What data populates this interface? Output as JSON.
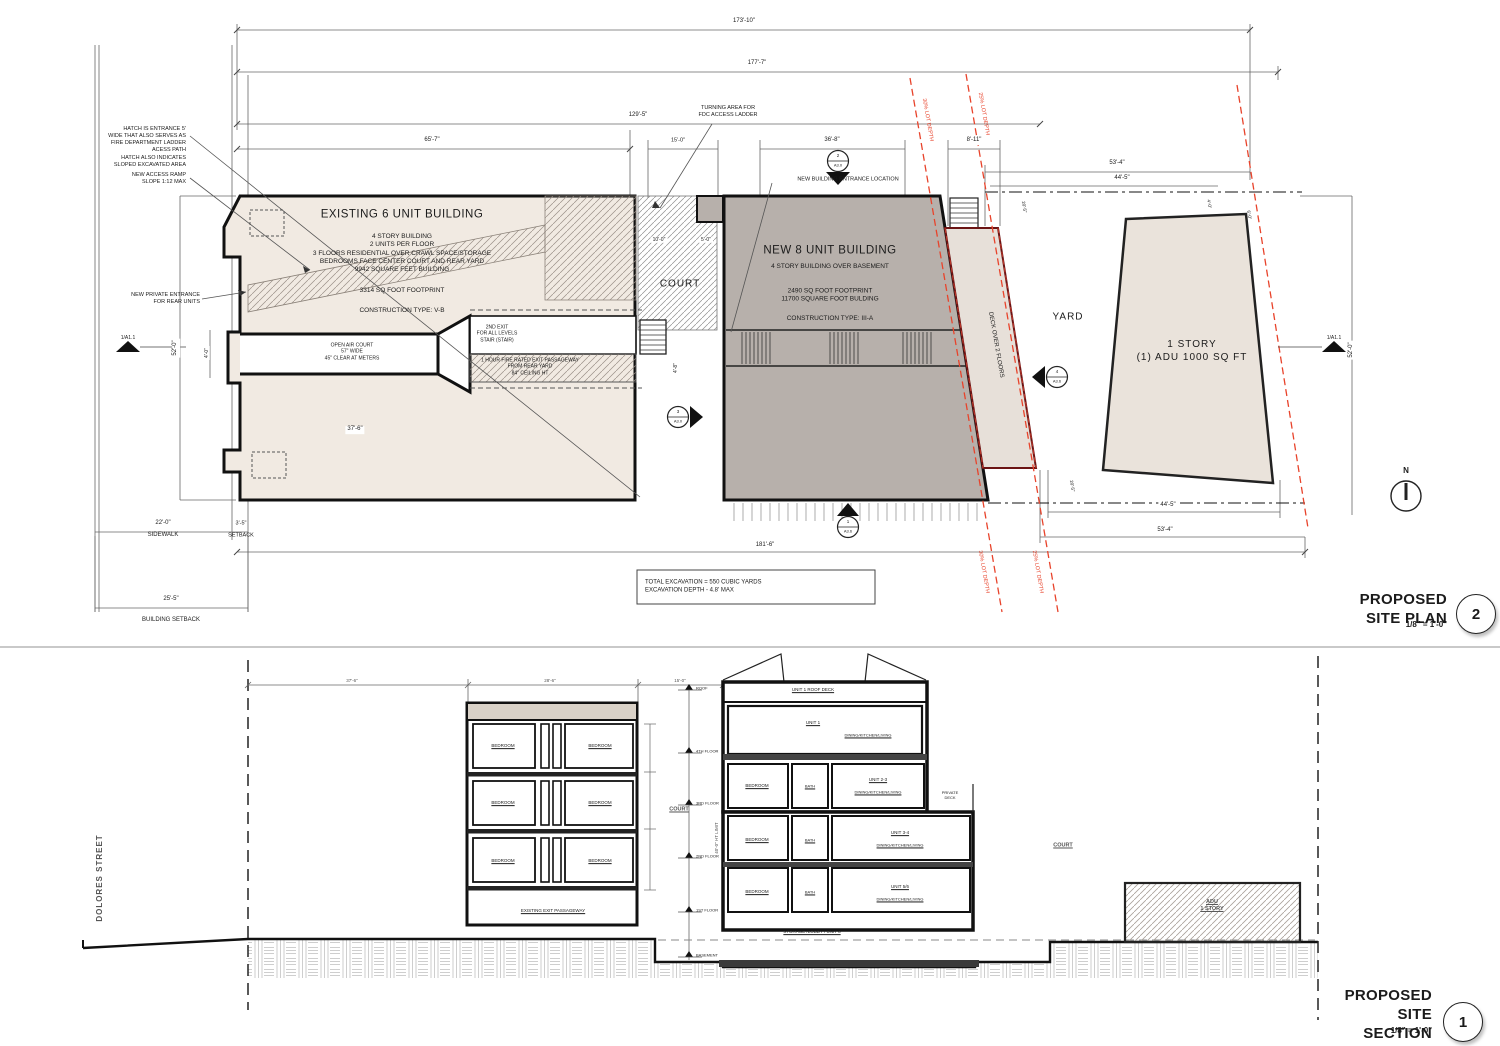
{
  "plan": {
    "title": "PROPOSED SITE PLAN",
    "scale": "1/8\" = 1'-0\"",
    "number": "2",
    "north_label": "N",
    "dims": {
      "overall_top": "173'-10\"",
      "overall_top2": "177'-7\"",
      "left_run": "129'-5\"",
      "existing_width": "65'-7\"",
      "court_width": "15'-0\"",
      "new_width": "36'-8\"",
      "gap": "8'-11\"",
      "right_top": "53'-4\"",
      "right_top2": "44'-5\"",
      "lot_bottom": "181'-6\"",
      "right_bottom": "44'-5\"",
      "right_bottom2": "53'-4\"",
      "sidewalk": "22'-0\"",
      "sidewalk_label": "SIDEWALK",
      "setback": "3'-5\"",
      "setback_label": "SETBACK",
      "building_setback": "25'-5\"",
      "building_setback_label": "BUILDING SETBACK",
      "depth_left": "52'-0\"",
      "depth_right": "52'-0\"",
      "recess": "4'-0\"",
      "court_open": "37'-6\"",
      "court_10": "10'-0\"",
      "court_5": "5'-0\"",
      "court_4_8": "4'-8\"",
      "adu_4": "4'-0\"",
      "adu_6": "6'-0\"",
      "deck_top": "20'-5\"",
      "deck_bottom": "20'-5\""
    },
    "notes": {
      "hatch": "HATCH IS ENTRANCE 5'\nWIDE THAT ALSO SERVES AS\nFIRE DEPARTMENT LADDER\nACESS PATH",
      "hatch2": "HATCH ALSO INDICATES\nSLOPED EXCAVATED AREA",
      "ramp": "NEW ACCESS RAMP\nSLOPE 1:12 MAX",
      "private_entrance": "NEW PRIVATE ENTRANCE\nFOR REAR UNITS",
      "turning": "TURNING AREA FOR\nFDC ACCESS LADDER",
      "new_entrance": "NEW BUILDING ENTRANCE LOCATION",
      "excavation": "TOTAL EXCAVATION = 550 CUBIC YARDS\nEXCAVATION DEPTH - 4.8' MAX"
    },
    "existing_building": {
      "title": "EXISTING 6 UNIT BUILDING",
      "details": "4 STORY BUILDING\n2 UNITS PER FLOOR\n3 FLOORS RESIDENTIAL OVER CRAWL SPACE/STORAGE\nBEDROOMS FACE CENTER COURT AND REAR YARD\n9942 SQUARE FEET BUILDING",
      "footprint": "3314 SQ FOOT FOOTPRINT",
      "construction": "CONSTRUCTION TYPE: V-B",
      "open_air_court": "OPEN AIR COURT\n57\" WIDE\n45\" CLEAR AT METERS",
      "second_exit": "2ND EXIT\nFOR ALL LEVELS\nSTAIR (STAIR)",
      "passageway": "1 HOUR FIRE RATED EXIT PASSAGEWAY\nFROM REAR YARD\n84\" CEILING HT"
    },
    "new_building": {
      "title": "NEW 8 UNIT BUILDING",
      "subtitle": "4 STORY BUILDING OVER BASEMENT",
      "details": "2490 SQ FOOT FOOTPRINT\n11700 SQUARE FOOT BULDING",
      "construction": "CONSTRUCTION TYPE: III-A"
    },
    "areas": {
      "court": "COURT",
      "yard": "YARD",
      "adu": "1 STORY\n(1) ADU 1000 SQ FT",
      "deck": "DECK OVER 2 FLOORS"
    },
    "lot_lines": {
      "lot30": "30% LOT DEPTH",
      "lot25": "25% LOT DEPTH"
    },
    "markers": {
      "m2_num": "2",
      "m2_sheet": "A3.0",
      "m3_num": "3",
      "m3_sheet": "A3.0",
      "m1_num": "1",
      "m1_sheet": "A3.6",
      "m4_num": "4",
      "m4_sheet": "A3.6",
      "section_ref": "1/A1.1"
    }
  },
  "section": {
    "title": "PROPOSED SITE SECTION",
    "scale": "1/8\" = 1'-0\"",
    "number": "1",
    "street": "DOLORES STREET",
    "dims": {
      "d1": "37'-6\"",
      "d2": "28'-6\"",
      "d3": "15'-0\""
    },
    "labels": {
      "bedroom": "BEDROOM",
      "bath": "BATH",
      "court": "COURT",
      "existing_passageway": "EXISTING EXIT PASSAGEWAY",
      "roof_deck": "UNIT 1 ROOF DECK",
      "unit1": "UNIT 1",
      "unit23": "UNIT 2-3",
      "unit34": "UNIT 3-4",
      "unit56": "UNIT 5/6",
      "dkl": "DINING/KITCHEN/LIVING",
      "private_deck": "PRIVATE\nDECK",
      "storage": "STORAGE /LOBBY / UNIT 8",
      "adu": "ADU\n1 STORY",
      "ht_limit": "40'-0\" HT LIMIT"
    },
    "levels": [
      "ROOF",
      "4TH FLOOR",
      "3RD FLOOR",
      "2ND FLOOR",
      "1ST FLOOR",
      "BASEMENT"
    ]
  }
}
